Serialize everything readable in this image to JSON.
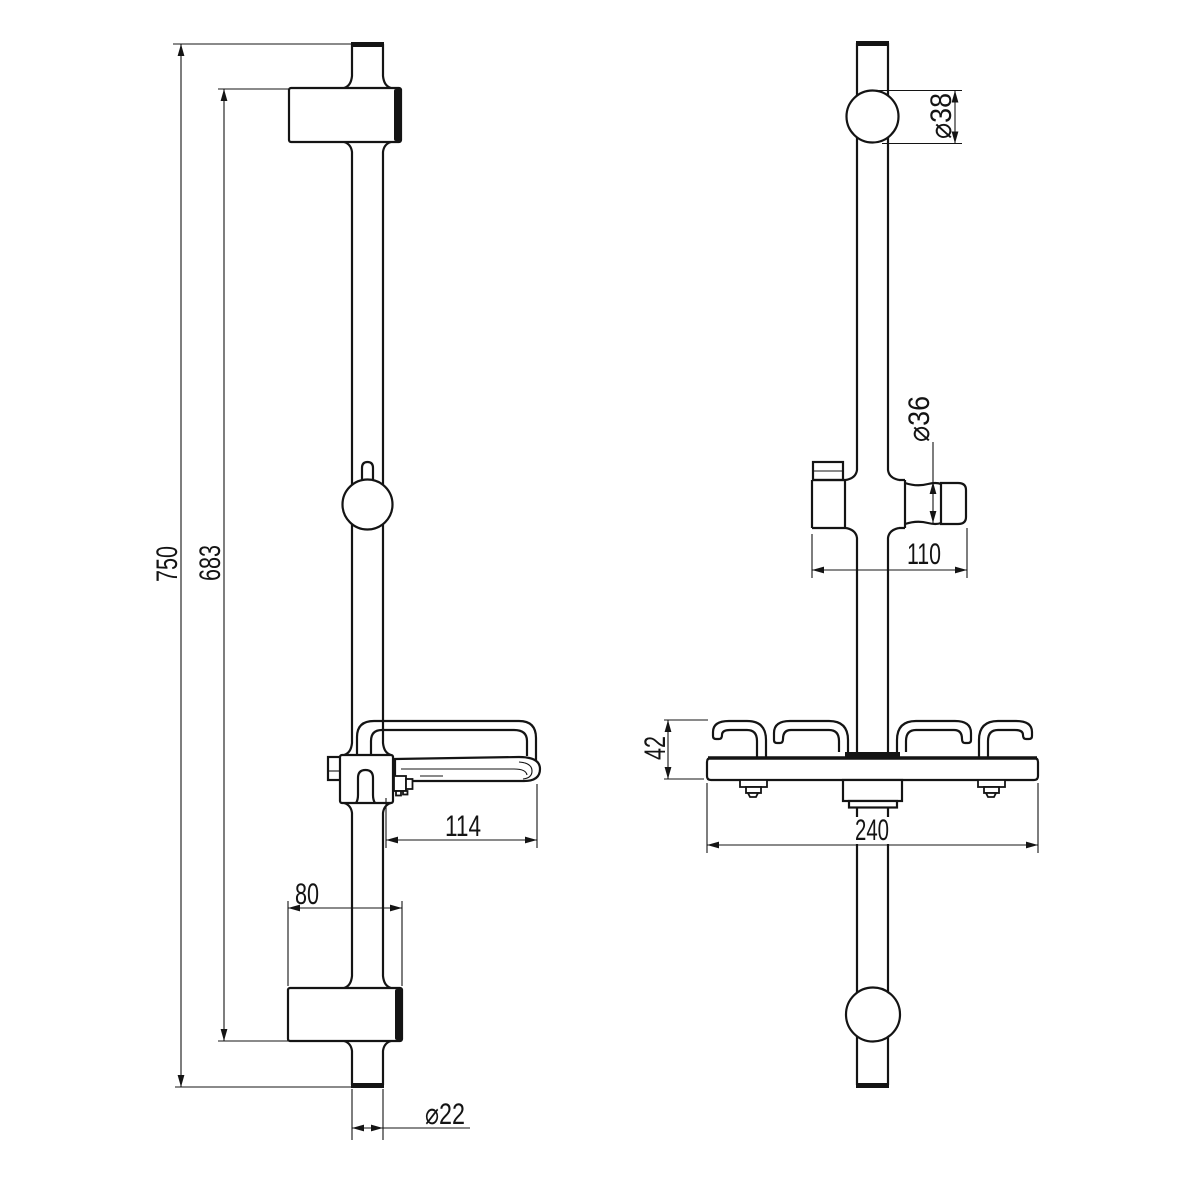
{
  "page": {
    "background": "#ffffff",
    "ink": "#141414"
  },
  "drawing": {
    "type": "technical-drawing",
    "subject": "shower slide bar with sliding holder and soap dish shelf, front and side elevations",
    "views": [
      {
        "id": "front",
        "name": "front elevation",
        "dimensions": [
          "d750",
          "d683",
          "d114",
          "d80",
          "d22"
        ]
      },
      {
        "id": "side",
        "name": "side elevation",
        "dimensions": [
          "d38",
          "d36",
          "d110",
          "d42",
          "d240"
        ]
      }
    ]
  },
  "dims": {
    "d750": "750",
    "d683": "683",
    "d114": "114",
    "d80": "80",
    "d22": "⌀22",
    "d38": "⌀38",
    "d36": "⌀36",
    "d110": "110",
    "d42": "42",
    "d240": "240"
  }
}
